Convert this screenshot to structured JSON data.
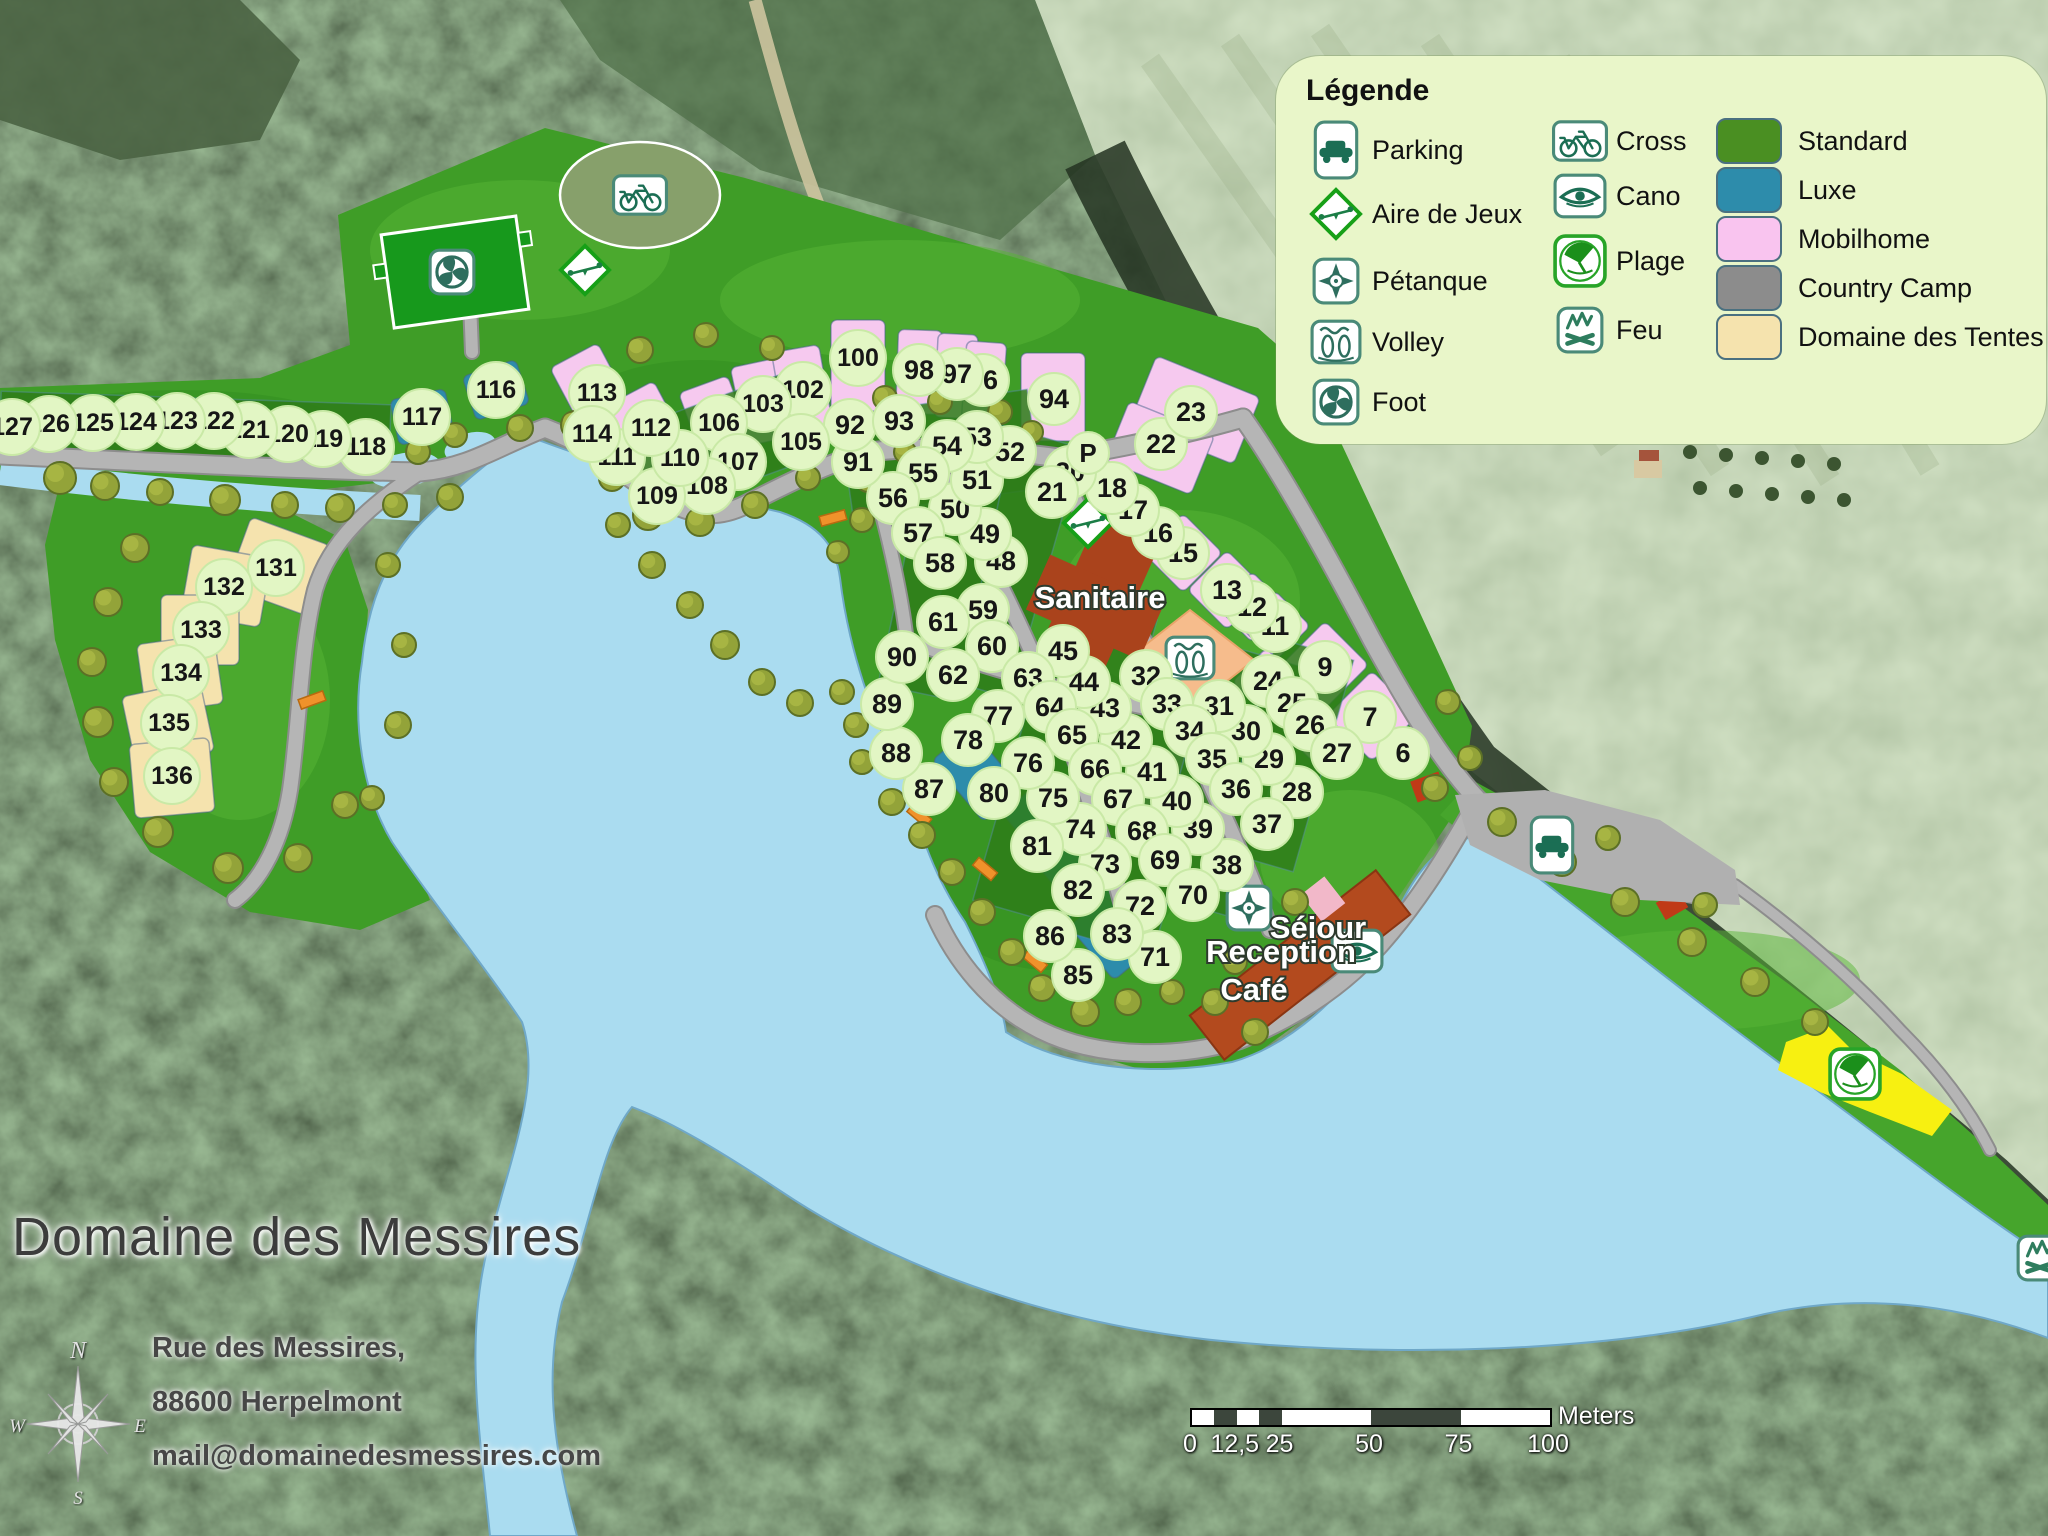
{
  "legend": {
    "title": "Légende",
    "activities_col1": [
      {
        "icon": "parking",
        "label": "Parking"
      },
      {
        "icon": "playground",
        "label": "Aire de Jeux"
      },
      {
        "icon": "petanque",
        "label": "Pétanque"
      },
      {
        "icon": "volley",
        "label": "Volley"
      },
      {
        "icon": "foot",
        "label": "Foot"
      }
    ],
    "activities_col2": [
      {
        "icon": "cross",
        "label": "Cross"
      },
      {
        "icon": "cano",
        "label": "Cano"
      },
      {
        "icon": "plage",
        "label": "Plage"
      },
      {
        "icon": "feu",
        "label": "Feu"
      }
    ],
    "pitch_types": [
      {
        "label": "Standard",
        "color": "#4a8f22"
      },
      {
        "label": "Luxe",
        "color": "#2d8cab"
      },
      {
        "label": "Mobilhome",
        "color": "#f9c4ef"
      },
      {
        "label": "Country Camp",
        "color": "#8c8c8c"
      },
      {
        "label": "Domaine des Tentes",
        "color": "#f5e3ae"
      }
    ]
  },
  "title_block": {
    "title": "Domaine des Messires",
    "address_line1": "Rue des Messires,",
    "address_line2": "88600 Herpelmont",
    "address_line3": "mail@domainedesmessires.com"
  },
  "compass": {
    "n": "N",
    "e": "E",
    "s": "S",
    "w": "W"
  },
  "scale_bar": {
    "unit": "Meters",
    "ticks": [
      {
        "label": "0",
        "frac": 0
      },
      {
        "label": "12,5",
        "frac": 0.125
      },
      {
        "label": "25",
        "frac": 0.25
      },
      {
        "label": "50",
        "frac": 0.5
      },
      {
        "label": "75",
        "frac": 0.75
      },
      {
        "label": "100",
        "frac": 1
      }
    ]
  },
  "map": {
    "labels": [
      {
        "text": "Sanitaire",
        "x": 1100,
        "y": 608
      },
      {
        "text": "Séjour",
        "x": 1318,
        "y": 938
      },
      {
        "text": "Reception",
        "x": 1281,
        "y": 962
      },
      {
        "text": "Café",
        "x": 1254,
        "y": 1000
      }
    ],
    "markers": [
      {
        "label": "P",
        "x": 1088,
        "y": 453
      }
    ],
    "facilities": [
      {
        "icon": "foot",
        "x": 452,
        "y": 272
      },
      {
        "icon": "cross",
        "x": 640,
        "y": 195
      },
      {
        "icon": "playground",
        "x": 585,
        "y": 270
      },
      {
        "icon": "playground",
        "x": 1088,
        "y": 523
      },
      {
        "icon": "volley",
        "x": 1190,
        "y": 658
      },
      {
        "icon": "petanque",
        "x": 1249,
        "y": 908
      },
      {
        "icon": "cano",
        "x": 1357,
        "y": 951
      },
      {
        "icon": "parking",
        "x": 1552,
        "y": 845
      },
      {
        "icon": "plage",
        "x": 1855,
        "y": 1074
      },
      {
        "icon": "feu",
        "x": 2040,
        "y": 1258
      }
    ],
    "pitches": [
      {
        "n": 6,
        "x": 1403,
        "y": 753
      },
      {
        "n": 7,
        "x": 1370,
        "y": 717
      },
      {
        "n": 9,
        "x": 1325,
        "y": 667
      },
      {
        "n": 11,
        "x": 1275,
        "y": 626
      },
      {
        "n": 12,
        "x": 1252,
        "y": 607
      },
      {
        "n": 13,
        "x": 1227,
        "y": 590
      },
      {
        "n": 15,
        "x": 1183,
        "y": 553
      },
      {
        "n": 16,
        "x": 1158,
        "y": 533
      },
      {
        "n": 17,
        "x": 1133,
        "y": 510
      },
      {
        "n": 18,
        "x": 1112,
        "y": 488
      },
      {
        "n": 20,
        "x": 1070,
        "y": 472
      },
      {
        "n": 21,
        "x": 1052,
        "y": 492
      },
      {
        "n": 22,
        "x": 1161,
        "y": 444
      },
      {
        "n": 23,
        "x": 1191,
        "y": 412
      },
      {
        "n": 24,
        "x": 1268,
        "y": 681
      },
      {
        "n": 25,
        "x": 1292,
        "y": 703
      },
      {
        "n": 26,
        "x": 1310,
        "y": 725
      },
      {
        "n": 27,
        "x": 1337,
        "y": 753
      },
      {
        "n": 28,
        "x": 1297,
        "y": 792
      },
      {
        "n": 29,
        "x": 1269,
        "y": 759
      },
      {
        "n": 30,
        "x": 1246,
        "y": 731
      },
      {
        "n": 31,
        "x": 1219,
        "y": 706
      },
      {
        "n": 32,
        "x": 1146,
        "y": 676
      },
      {
        "n": 33,
        "x": 1167,
        "y": 704
      },
      {
        "n": 34,
        "x": 1190,
        "y": 731
      },
      {
        "n": 35,
        "x": 1212,
        "y": 759
      },
      {
        "n": 36,
        "x": 1236,
        "y": 789
      },
      {
        "n": 37,
        "x": 1267,
        "y": 824
      },
      {
        "n": 38,
        "x": 1227,
        "y": 865
      },
      {
        "n": 39,
        "x": 1198,
        "y": 829
      },
      {
        "n": 40,
        "x": 1177,
        "y": 801
      },
      {
        "n": 41,
        "x": 1152,
        "y": 772
      },
      {
        "n": 42,
        "x": 1126,
        "y": 740
      },
      {
        "n": 43,
        "x": 1105,
        "y": 708
      },
      {
        "n": 44,
        "x": 1084,
        "y": 682
      },
      {
        "n": 45,
        "x": 1063,
        "y": 651
      },
      {
        "n": 48,
        "x": 1001,
        "y": 561
      },
      {
        "n": 49,
        "x": 985,
        "y": 534
      },
      {
        "n": 50,
        "x": 955,
        "y": 509
      },
      {
        "n": 51,
        "x": 977,
        "y": 480
      },
      {
        "n": 52,
        "x": 1010,
        "y": 452
      },
      {
        "n": 53,
        "x": 977,
        "y": 437
      },
      {
        "n": 54,
        "x": 947,
        "y": 446
      },
      {
        "n": 55,
        "x": 923,
        "y": 473
      },
      {
        "n": 56,
        "x": 893,
        "y": 498
      },
      {
        "n": 57,
        "x": 918,
        "y": 533
      },
      {
        "n": 58,
        "x": 940,
        "y": 563
      },
      {
        "n": 59,
        "x": 983,
        "y": 610
      },
      {
        "n": 60,
        "x": 992,
        "y": 646
      },
      {
        "n": 61,
        "x": 943,
        "y": 622
      },
      {
        "n": 62,
        "x": 953,
        "y": 675
      },
      {
        "n": 63,
        "x": 1028,
        "y": 678
      },
      {
        "n": 64,
        "x": 1050,
        "y": 707
      },
      {
        "n": 65,
        "x": 1072,
        "y": 735
      },
      {
        "n": 66,
        "x": 1095,
        "y": 769
      },
      {
        "n": 67,
        "x": 1118,
        "y": 799
      },
      {
        "n": 68,
        "x": 1142,
        "y": 831
      },
      {
        "n": 69,
        "x": 1165,
        "y": 860
      },
      {
        "n": 70,
        "x": 1193,
        "y": 895
      },
      {
        "n": 71,
        "x": 1155,
        "y": 957
      },
      {
        "n": 72,
        "x": 1140,
        "y": 906
      },
      {
        "n": 73,
        "x": 1105,
        "y": 864
      },
      {
        "n": 74,
        "x": 1080,
        "y": 829
      },
      {
        "n": 75,
        "x": 1053,
        "y": 798
      },
      {
        "n": 76,
        "x": 1028,
        "y": 763
      },
      {
        "n": 77,
        "x": 998,
        "y": 716
      },
      {
        "n": 78,
        "x": 968,
        "y": 740
      },
      {
        "n": 80,
        "x": 994,
        "y": 793
      },
      {
        "n": 81,
        "x": 1037,
        "y": 846
      },
      {
        "n": 82,
        "x": 1078,
        "y": 890
      },
      {
        "n": 83,
        "x": 1117,
        "y": 934
      },
      {
        "n": 85,
        "x": 1078,
        "y": 975
      },
      {
        "n": 86,
        "x": 1050,
        "y": 936
      },
      {
        "n": 87,
        "x": 929,
        "y": 789
      },
      {
        "n": 88,
        "x": 896,
        "y": 753
      },
      {
        "n": 89,
        "x": 887,
        "y": 704
      },
      {
        "n": 90,
        "x": 902,
        "y": 657
      },
      {
        "n": 91,
        "x": 858,
        "y": 462
      },
      {
        "n": 92,
        "x": 850,
        "y": 425
      },
      {
        "n": 93,
        "x": 899,
        "y": 421
      },
      {
        "n": 94,
        "x": 1054,
        "y": 399
      },
      {
        "n": 96,
        "x": 983,
        "y": 380
      },
      {
        "n": 97,
        "x": 957,
        "y": 374
      },
      {
        "n": 98,
        "x": 919,
        "y": 370
      },
      {
        "n": 100,
        "x": 858,
        "y": 358
      },
      {
        "n": 102,
        "x": 803,
        "y": 390
      },
      {
        "n": 103,
        "x": 763,
        "y": 404
      },
      {
        "n": 105,
        "x": 801,
        "y": 442
      },
      {
        "n": 106,
        "x": 719,
        "y": 423
      },
      {
        "n": 107,
        "x": 738,
        "y": 462
      },
      {
        "n": 108,
        "x": 707,
        "y": 486
      },
      {
        "n": 109,
        "x": 657,
        "y": 496
      },
      {
        "n": 110,
        "x": 680,
        "y": 458
      },
      {
        "n": 111,
        "x": 617,
        "y": 457
      },
      {
        "n": 112,
        "x": 651,
        "y": 428
      },
      {
        "n": 113,
        "x": 597,
        "y": 393
      },
      {
        "n": 114,
        "x": 592,
        "y": 434
      },
      {
        "n": 116,
        "x": 496,
        "y": 390
      },
      {
        "n": 117,
        "x": 422,
        "y": 417
      },
      {
        "n": 118,
        "x": 366,
        "y": 447
      },
      {
        "n": 119,
        "x": 323,
        "y": 439
      },
      {
        "n": 120,
        "x": 288,
        "y": 434
      },
      {
        "n": 121,
        "x": 249,
        "y": 430
      },
      {
        "n": 122,
        "x": 214,
        "y": 421
      },
      {
        "n": 123,
        "x": 177,
        "y": 421
      },
      {
        "n": 124,
        "x": 136,
        "y": 422
      },
      {
        "n": 125,
        "x": 93,
        "y": 423
      },
      {
        "n": 126,
        "x": 49,
        "y": 424
      },
      {
        "n": 127,
        "x": 12,
        "y": 427
      },
      {
        "n": 131,
        "x": 276,
        "y": 568
      },
      {
        "n": 132,
        "x": 224,
        "y": 587
      },
      {
        "n": 133,
        "x": 201,
        "y": 630
      },
      {
        "n": 134,
        "x": 181,
        "y": 673
      },
      {
        "n": 135,
        "x": 169,
        "y": 723
      },
      {
        "n": 136,
        "x": 172,
        "y": 776
      }
    ]
  }
}
